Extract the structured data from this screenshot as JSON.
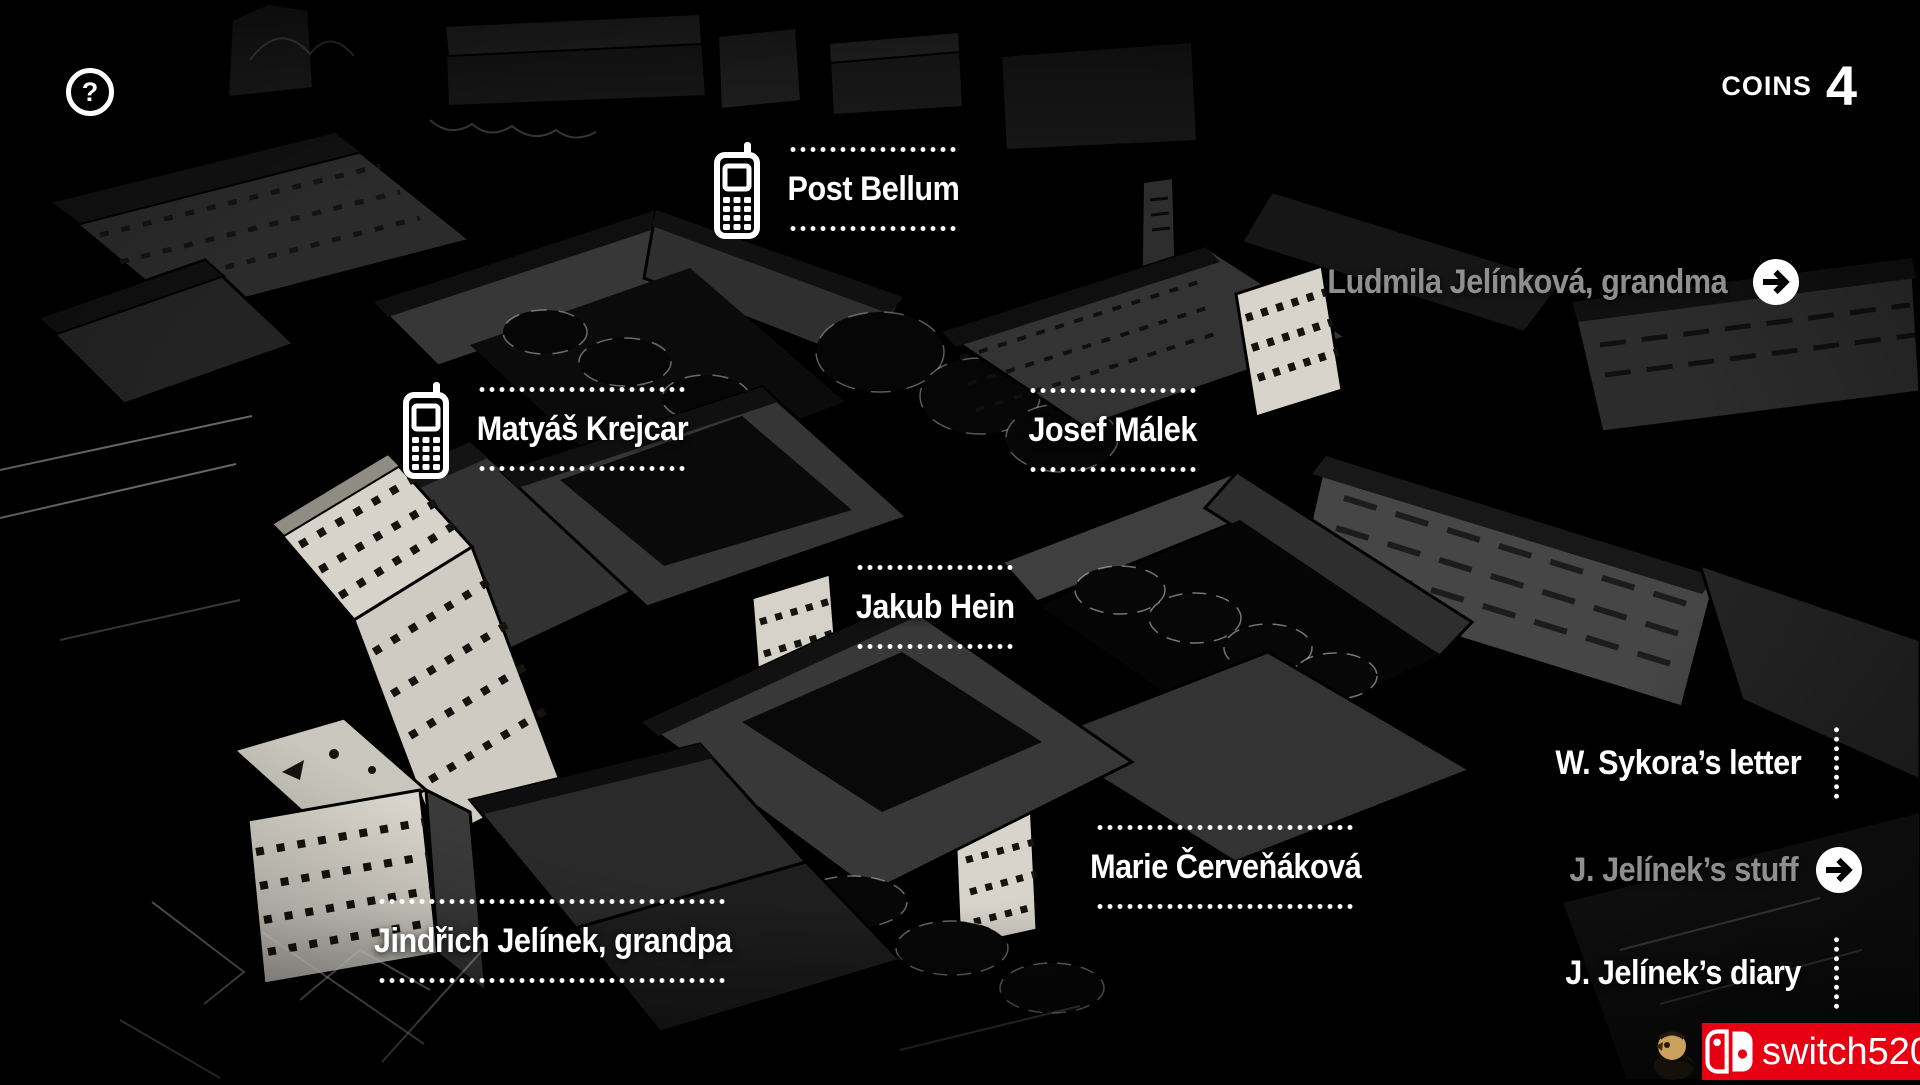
{
  "colors": {
    "background": "#000000",
    "text": "#ffffff",
    "dim_text": "#8f8f8f",
    "banner_red": "#e60012"
  },
  "hud": {
    "help_glyph": "?",
    "coins_label": "COINS",
    "coins_value": "4"
  },
  "labels": {
    "post_bellum": "Post Bellum",
    "matyas_krejcar": "Matyáš Krejcar",
    "josef_malek": "Josef Málek",
    "ludmila": "Ludmila Jelínková, grandma",
    "jakub_hein": "Jakub Hein",
    "marie": "Marie Červeňáková",
    "jindrich": "Jindřich Jelínek, grandpa",
    "sykora_letter": "W. Sykora’s letter",
    "jelinek_stuff": "J. Jelínek’s stuff",
    "jelinek_diary": "J. Jelínek’s diary"
  },
  "icons": {
    "help": "question-mark-in-circle",
    "phone": "mobile-phone",
    "arrow": "arrow-right-in-circle",
    "dotted_line": "white-dotted-line",
    "switch_logo": "nintendo-switch-logo",
    "bird": "owl-mascot"
  },
  "watermark": {
    "text": "switch520"
  }
}
